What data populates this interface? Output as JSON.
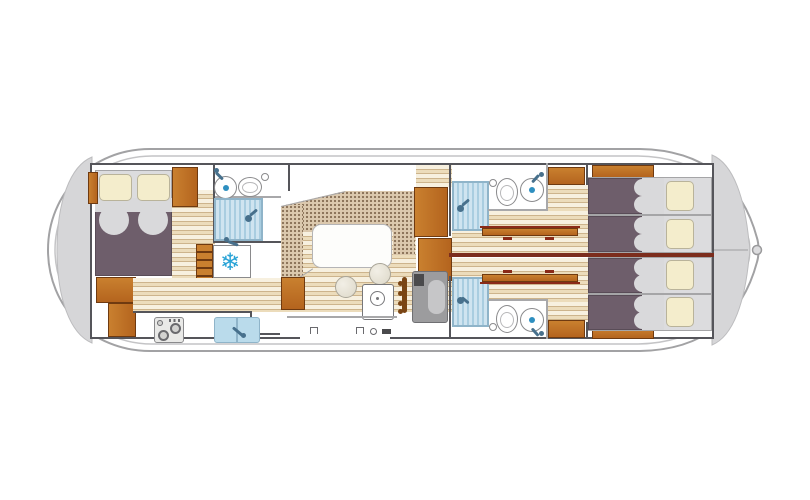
{
  "diagram": {
    "type": "houseboat-floor-plan",
    "view": "top-down deck plan",
    "rooms": [
      "aft-double-cabin",
      "aft-bathroom",
      "galley",
      "saloon-dinette",
      "helm-station",
      "forward-port-cabin",
      "forward-starboard-cabin",
      "forward-port-bathroom",
      "forward-starboard-bathroom",
      "bow-twin-beds",
      "bow-deck",
      "stern-deck"
    ],
    "fixtures": [
      "double-bed",
      "single-bed-1",
      "single-bed-2",
      "single-bed-3",
      "single-bed-4",
      "fridge-snowflake-icon",
      "stove-burners-icon",
      "galley-sink",
      "shower-aft",
      "shower-forward-port",
      "shower-forward-starboard",
      "toilet-aft",
      "toilet-forward-port",
      "toilet-forward-starboard",
      "washbasin-aft",
      "washbasin-forward-port",
      "washbasin-forward-starboard",
      "dinette-table",
      "stool",
      "steering-wheel-icon",
      "helm-seat",
      "companionway-steps",
      "wardrobe",
      "fold-table",
      "bow-cleat"
    ],
    "fridge_glyph": "❄"
  },
  "colors": {
    "hull_stroke": "#a2a2a4",
    "hull_inner": "#c4c4c6",
    "deck": "#d6d6d8",
    "wall": "#55555a",
    "wall_red": "#7c2d1d",
    "wood": "#b4641e",
    "wood_light": "#c9802f",
    "wood_border": "#6f3a10",
    "plank_light": "#f7f0df",
    "plank_mid": "#ecdcbb",
    "plank_line": "#cdb48c",
    "fabric": "#dcc9ae",
    "fabric_dot": "#8a7158",
    "table": "#fdfdfb",
    "blanket": "#6e5e6b",
    "blanket_border": "#594c57",
    "sheet": "#d9d9db",
    "pillow": "#f4edcc",
    "pillow_border": "#b9b39a",
    "shower": "#cfe4f0",
    "shower_stripe": "#a9cde0",
    "shower_border": "#8fb4c9",
    "water": "#2e8fc0",
    "snowflake": "#29a3d6",
    "appliance": "#e9e9e7",
    "appliance_border": "#8a8a8c",
    "seat": "#9c9c9e",
    "seat_inner": "#c6c6c8",
    "steel": "#47708c",
    "line_light": "#a8a8aa",
    "bedbase": "#dcdcde"
  }
}
